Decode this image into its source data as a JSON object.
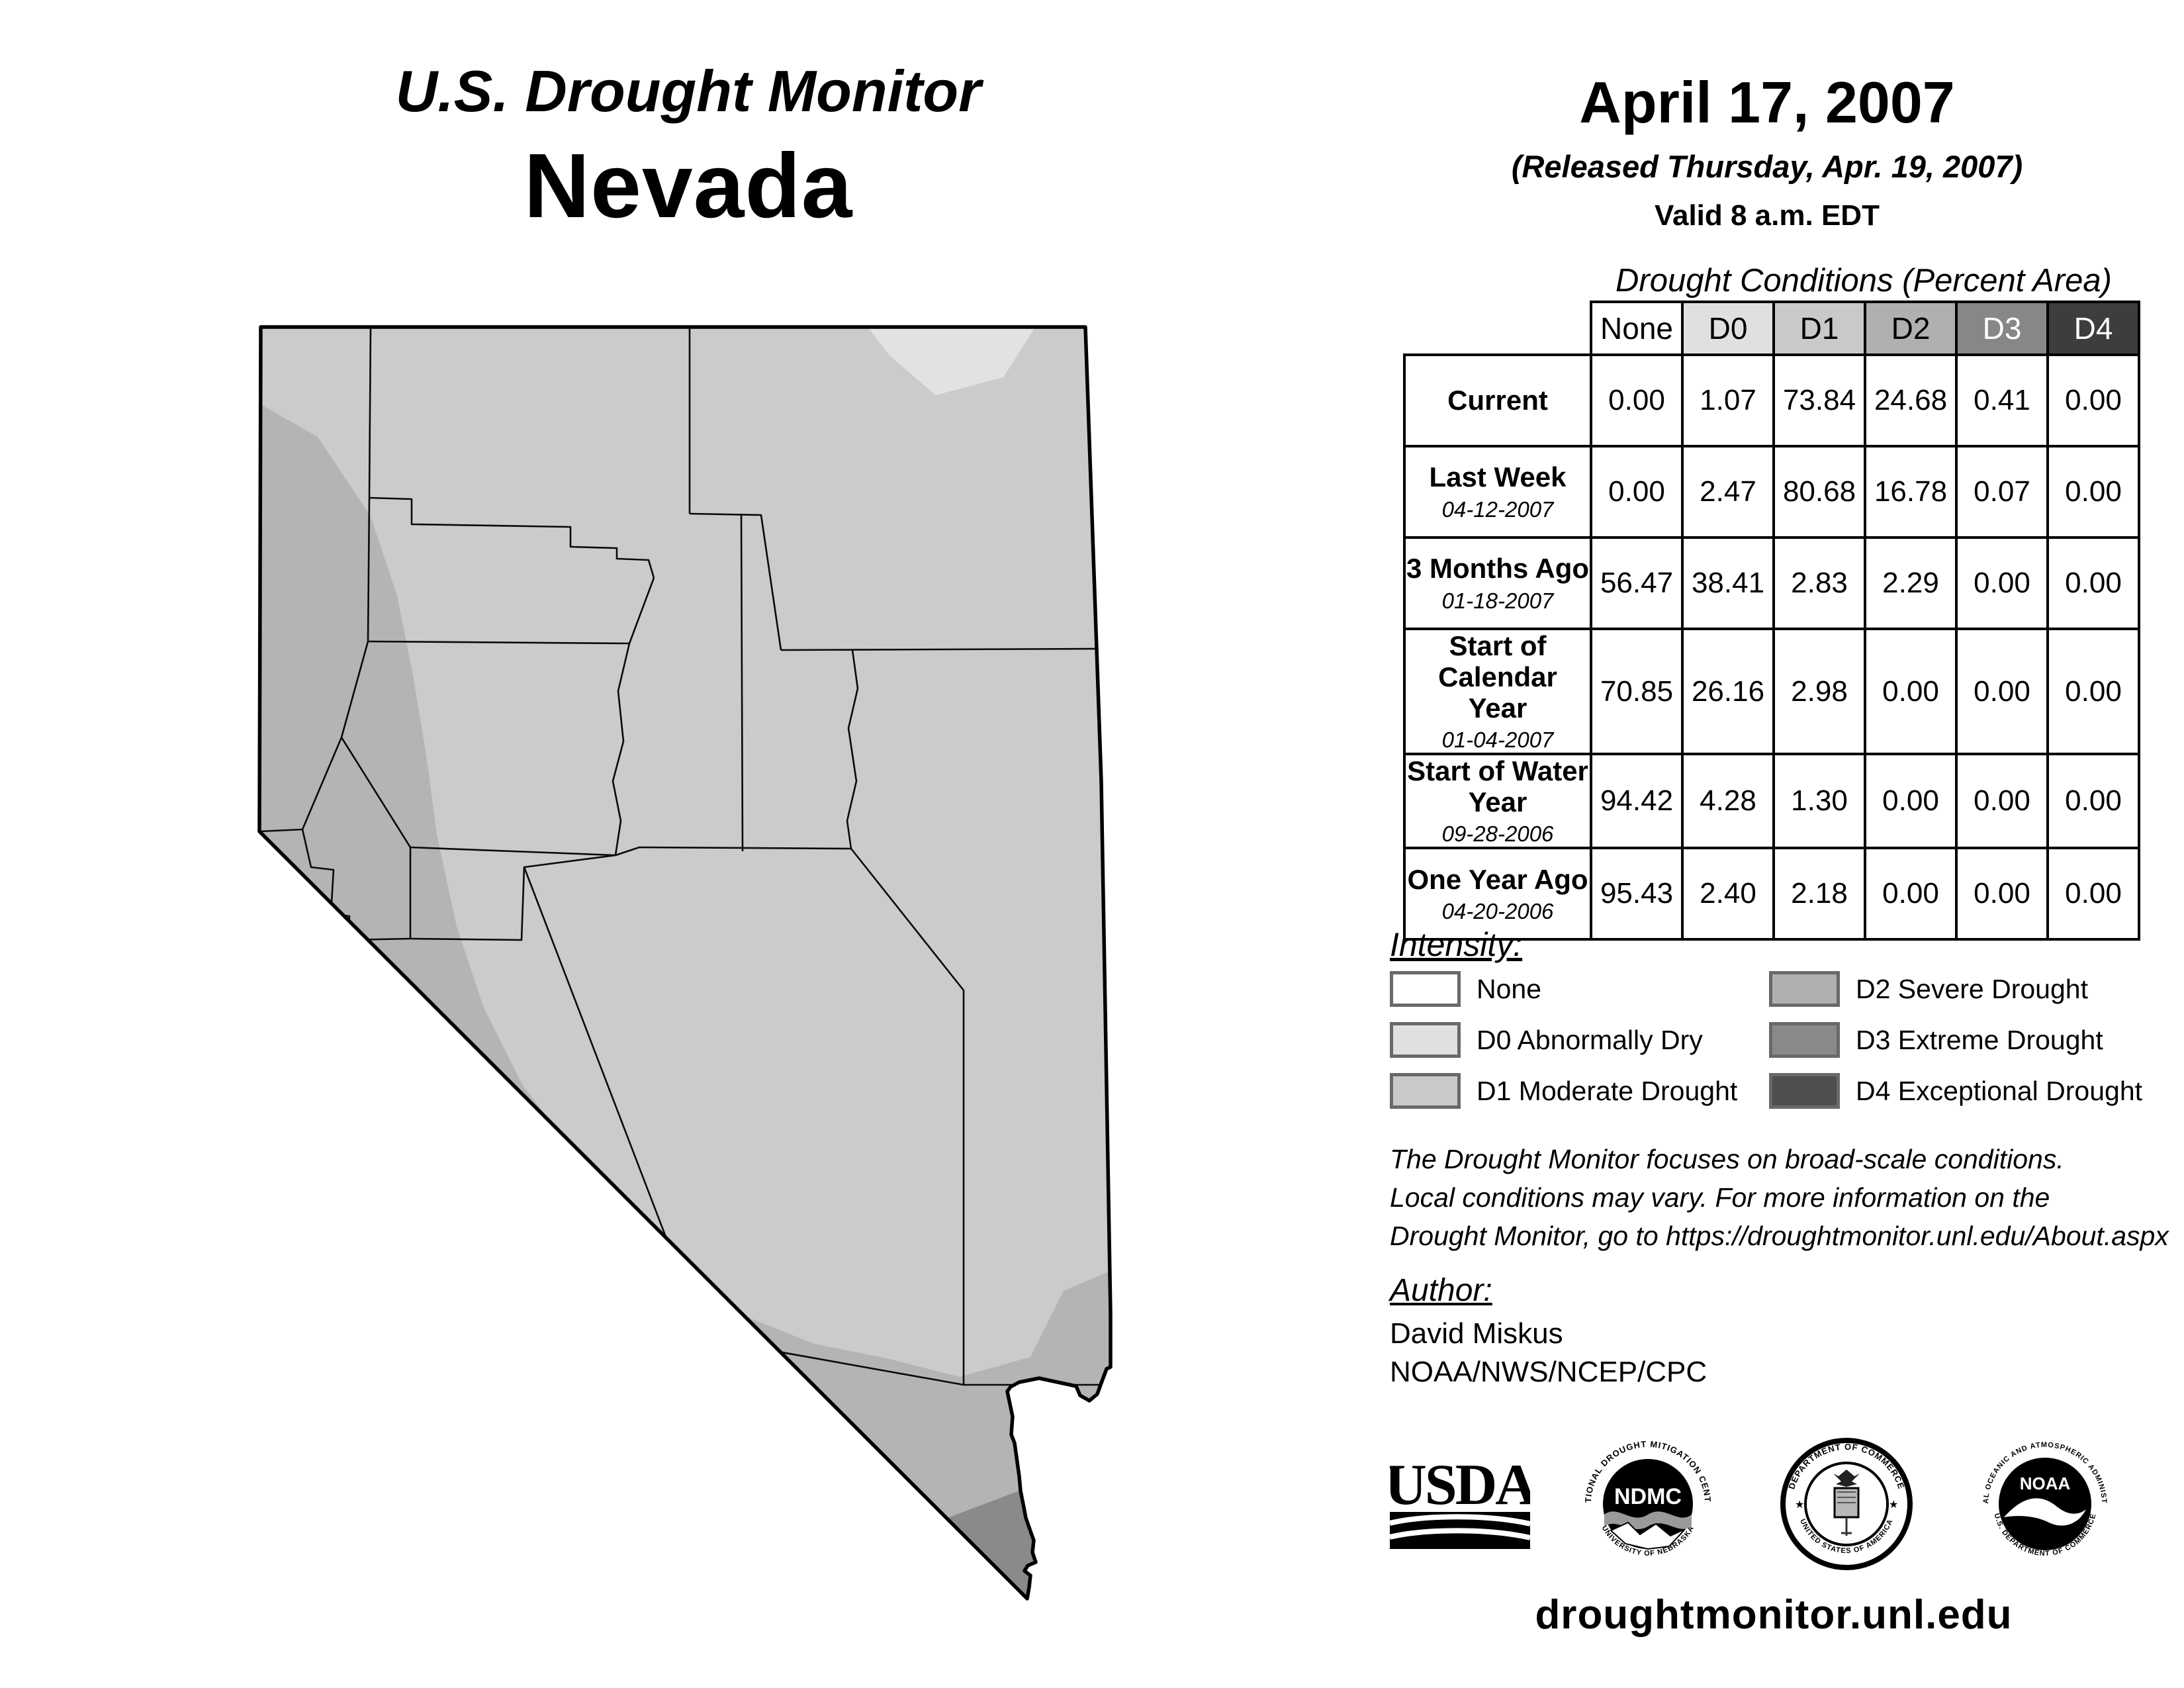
{
  "header": {
    "title": "U.S. Drought Monitor",
    "region": "Nevada",
    "date": "April 17, 2007",
    "released": "(Released Thursday, Apr. 19, 2007)",
    "valid": "Valid 8 a.m. EDT"
  },
  "table": {
    "title": "Drought Conditions (Percent Area)",
    "columns": [
      {
        "label": "None",
        "color": "#ffffff"
      },
      {
        "label": "D0",
        "color": "#e0e0e0"
      },
      {
        "label": "D1",
        "color": "#c9c9c9"
      },
      {
        "label": "D2",
        "color": "#b0b0b0"
      },
      {
        "label": "D3",
        "color": "#878787"
      },
      {
        "label": "D4",
        "color": "#3d3d3d"
      }
    ],
    "rows": [
      {
        "label": "Current",
        "date": "",
        "values": [
          "0.00",
          "1.07",
          "73.84",
          "24.68",
          "0.41",
          "0.00"
        ]
      },
      {
        "label": "Last Week",
        "date": "04-12-2007",
        "values": [
          "0.00",
          "2.47",
          "80.68",
          "16.78",
          "0.07",
          "0.00"
        ]
      },
      {
        "label": "3 Months Ago",
        "date": "01-18-2007",
        "values": [
          "56.47",
          "38.41",
          "2.83",
          "2.29",
          "0.00",
          "0.00"
        ]
      },
      {
        "label": "Start of Calendar Year",
        "date": "01-04-2007",
        "values": [
          "70.85",
          "26.16",
          "2.98",
          "0.00",
          "0.00",
          "0.00"
        ]
      },
      {
        "label": "Start of Water Year",
        "date": "09-28-2006",
        "values": [
          "94.42",
          "4.28",
          "1.30",
          "0.00",
          "0.00",
          "0.00"
        ]
      },
      {
        "label": "One Year Ago",
        "date": "04-20-2006",
        "values": [
          "95.43",
          "2.40",
          "2.18",
          "0.00",
          "0.00",
          "0.00"
        ]
      }
    ]
  },
  "legend": {
    "heading": "Intensity:",
    "left_items": [
      {
        "label": "None",
        "color": "#ffffff"
      },
      {
        "label": "D0 Abnormally Dry",
        "color": "#e0e0e0"
      },
      {
        "label": "D1 Moderate Drought",
        "color": "#c9c9c9"
      }
    ],
    "right_items": [
      {
        "label": "D2 Severe Drought",
        "color": "#b0b0b0"
      },
      {
        "label": "D3 Extreme Drought",
        "color": "#8a8a8a"
      },
      {
        "label": "D4 Exceptional Drought",
        "color": "#4f4f4f"
      }
    ]
  },
  "disclaimer": {
    "lines": [
      "The Drought Monitor focuses on broad-scale conditions.",
      "Local conditions may vary. For more information on the",
      "Drought Monitor, go to https://droughtmonitor.unl.edu/About.aspx"
    ]
  },
  "author": {
    "heading": "Author:",
    "name": "David Miskus",
    "org": "NOAA/NWS/NCEP/CPC"
  },
  "logos": [
    {
      "label": "USDA"
    },
    {
      "label": "NDMC",
      "ring_top": "NATIONAL DROUGHT MITIGATION CENTER",
      "ring_bottom": "UNIVERSITY OF NEBRASKA"
    },
    {
      "label": "",
      "ring_top": "DEPARTMENT OF COMMERCE",
      "ring_bottom": "UNITED STATES OF AMERICA"
    },
    {
      "label": "NOAA",
      "ring_top": "NATIONAL OCEANIC AND ATMOSPHERIC ADMINISTRATION",
      "ring_bottom": "U.S. DEPARTMENT OF COMMERCE"
    }
  ],
  "footer": {
    "url": "droughtmonitor.unl.edu"
  },
  "map": {
    "region": "Nevada",
    "fills": {
      "d0": "#e2e2e2",
      "d1": "#cbcbcb",
      "d2": "#b4b4b4",
      "d3": "#8a8a8a"
    }
  }
}
